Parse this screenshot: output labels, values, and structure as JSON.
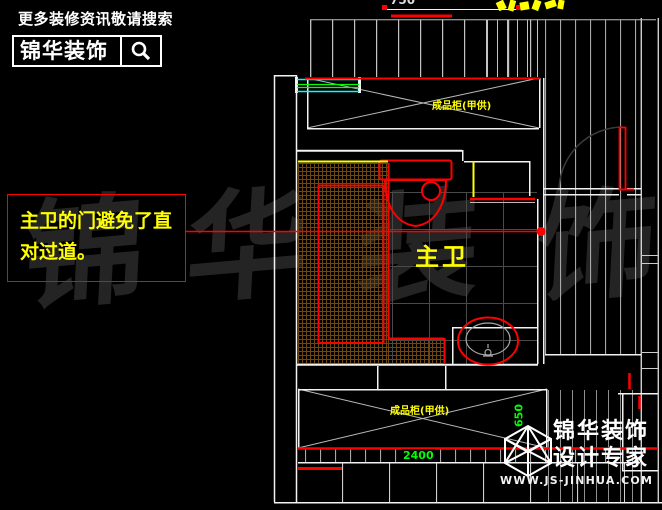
{
  "header": {
    "tagline": "更多装修资讯敬请搜索",
    "logo_text": "锦华装饰"
  },
  "callout": {
    "line1": "主卫的门避免了直",
    "line2": "对过道。"
  },
  "watermark": {
    "chars": [
      "锦",
      "华",
      "装",
      "饰"
    ]
  },
  "plan": {
    "room_label": "主卫",
    "top_cabinet_label": "成品柜(甲供)",
    "bottom_cabinet_label": "成品柜(甲供)",
    "dims": {
      "top": "750",
      "bottom": "2400",
      "right": "650"
    },
    "colors": {
      "wall_line": "#f2f2f2",
      "fixture_red": "#ff0000",
      "dimension_green": "#00ff00",
      "label_yellow": "#ffff00",
      "window_cyan": "#00ffff",
      "window_green": "#00ff00",
      "tile_hatch": "#6e4610"
    }
  },
  "footer_logo": {
    "brand": "锦华装饰",
    "subtitle": "设计专家",
    "website": "WWW.JS-JINHUA.COM"
  }
}
